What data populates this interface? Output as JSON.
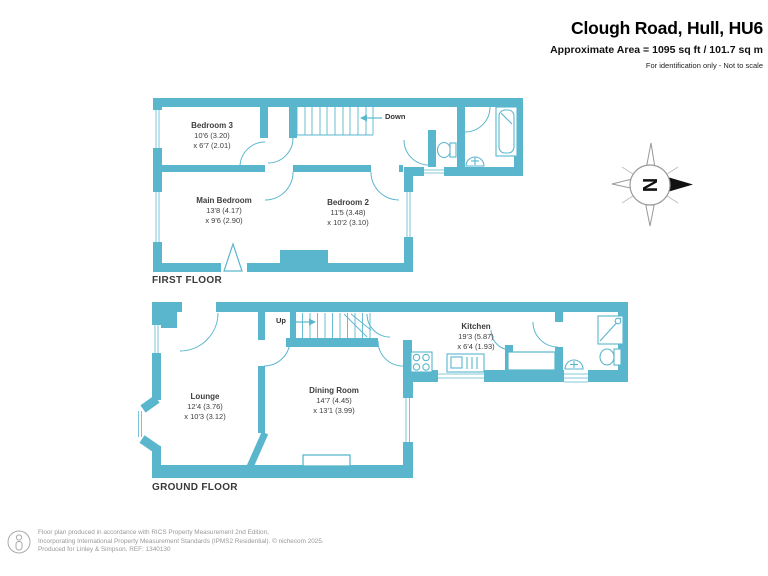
{
  "header": {
    "title": "Clough Road, Hull, HU6",
    "area_line": "Approximate Area = 1095 sq ft / 101.7 sq m",
    "disclaimer": "For identification only - Not to scale"
  },
  "floors": {
    "first": {
      "label": "FIRST FLOOR",
      "stairs_label": "Down",
      "rooms": [
        {
          "name": "Bedroom 3",
          "dim1": "10'6 (3.20)",
          "dim2": "x 6'7 (2.01)"
        },
        {
          "name": "Main Bedroom",
          "dim1": "13'8 (4.17)",
          "dim2": "x 9'6 (2.90)"
        },
        {
          "name": "Bedroom 2",
          "dim1": "11'5 (3.48)",
          "dim2": "x 10'2 (3.10)"
        }
      ]
    },
    "ground": {
      "label": "GROUND FLOOR",
      "stairs_label": "Up",
      "rooms": [
        {
          "name": "Lounge",
          "dim1": "12'4 (3.76)",
          "dim2": "x 10'3 (3.12)"
        },
        {
          "name": "Dining Room",
          "dim1": "14'7 (4.45)",
          "dim2": "x 13'1 (3.99)"
        },
        {
          "name": "Kitchen",
          "dim1": "19'3 (5.87)",
          "dim2": "x 6'4 (1.93)"
        }
      ]
    }
  },
  "compass": {
    "north_label": "N"
  },
  "footer": {
    "line1": "Floor plan produced in accordance with RICS Property Measurement 2nd Edition,",
    "line2": "Incorporating International Property Measurement Standards (IPMS2 Residential).  © nichecom 2025.",
    "line3": "Produced for Linley & Simpson.   REF: 1340130"
  },
  "colors": {
    "wall_teal": "#5AB6CD",
    "title_text": "#000000",
    "label_text": "#3D3D3D",
    "footer_text": "#999999"
  }
}
